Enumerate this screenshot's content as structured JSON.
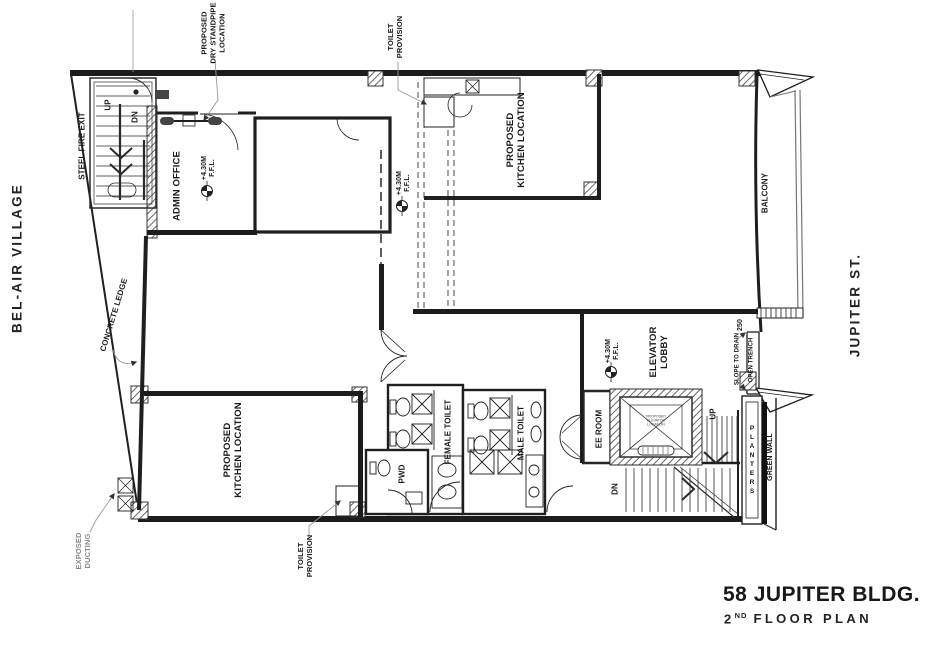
{
  "streets": {
    "left": "BEL-AIR VILLAGE",
    "right": "JUPITER ST."
  },
  "title_block": {
    "building": "58 JUPITER BLDG.",
    "floor_number": "2",
    "floor_ordinal": "ND",
    "floor_text": "FLOOR PLAN"
  },
  "levels": {
    "elevation": "+4.30M",
    "datum": "F.F.L."
  },
  "dimensions": {
    "trench_width": "250"
  },
  "rooms": {
    "steel_fire_exit": "STEEL FIRE EXIT",
    "admin_office": "ADMIN OFFICE",
    "kitchen_top": {
      "lines": [
        "PROPOSED",
        "KITCHEN LOCATION"
      ]
    },
    "kitchen_bottom": {
      "lines": [
        "PROPOSED",
        "KITCHEN LOCATION"
      ]
    },
    "balcony": "BALCONY",
    "elevator_lobby": {
      "lines": [
        "ELEVATOR",
        "LOBBY"
      ]
    },
    "ee_room": "EE ROOM",
    "female_toilet": "FEMALE TOILET",
    "male_toilet": "MALE TOILET",
    "pwd_toilet": "PWD",
    "planters": "PLANTERS",
    "green_wall": "GREEN WALL"
  },
  "annotations": {
    "dry_standpipe": {
      "lines": [
        "PROPOSED",
        "DRY STANDPIPE",
        "LOCATION"
      ]
    },
    "toilet_provision_top": {
      "lines": [
        "TOILET",
        "PROVISION"
      ]
    },
    "toilet_provision_bottom": {
      "lines": [
        "TOILET",
        "PROVISION"
      ]
    },
    "exposed_ducting": {
      "lines": [
        "EXPOSED",
        "DUCTING"
      ]
    },
    "concrete_ledge": "CONCRETE LEDGE",
    "slope_to_drain": "SLOPE TO DRAIN",
    "open_trench": "OPEN TRENCH",
    "elevator_note": {
      "lines": [
        "PROPOSED",
        "ELEVATOR",
        "LOCATION"
      ]
    }
  },
  "stairs": {
    "up_fire_exit": "UP",
    "dn_fire_exit": "DN",
    "up_main": "UP",
    "dn_main": "DN"
  },
  "colors": {
    "line": "#1f1f1f",
    "leader": "#9a9a9a",
    "text": "#1b1b1b",
    "muted": "#8a8a8a"
  }
}
